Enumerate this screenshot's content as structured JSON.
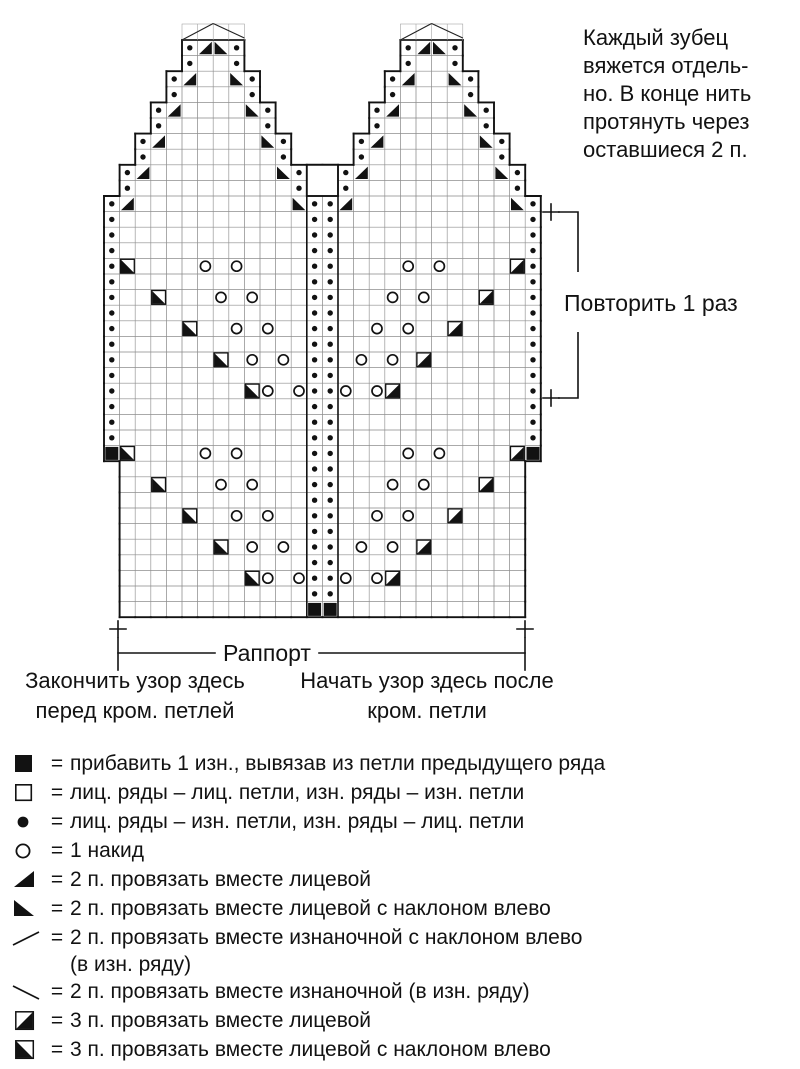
{
  "note": {
    "lines": [
      "Каждый зубец",
      "вяжется отдель-",
      "но. В конце нить",
      "протянуть через",
      "оставшиеся 2 п."
    ]
  },
  "repeat_label": "Повторить 1 раз",
  "rapport_label": "Раппорт",
  "end_label": {
    "line1": "Закончить узор здесь",
    "line2": "перед кром. петлей"
  },
  "start_label": {
    "line1": "Начать узор здесь после",
    "line2": "кром. петли"
  },
  "legend_eq": "=",
  "chart": {
    "type": "knitting-chart",
    "columns": 28,
    "rows": 37,
    "cell_codes": {
      "p": "purl-dot",
      ".": "knit-empty-cell",
      "O": "yarnover-circle",
      "a": "k2tog-filled-triangle-bottom-right",
      "b": "k2tog-left-filled-triangle-bottom-left",
      "q": "k3tog-left-square-lower-left-filled",
      "d": "k3tog-square-lower-right-filled",
      "M": "make1-purl-filled-square",
      "X": "tooth-join-box",
      "_": "no-cell"
    },
    "rows_top_to_bottom": [
      "_____pabp__________pabp_____",
      "_____p..p__________p..p_____",
      "____pa..bp________pa..bp____",
      "____p....p________p....p____",
      "___pa....bp______pa....bp___",
      "___p......p______p......p___",
      "__pa......bp____pa......bp__",
      "__p........p____p........p__",
      "_pa........bpXXpa........bp_",
      "_p..........pXXp..........p_",
      "pa..........bppa..........bp",
      "p............pp............p",
      "p............pp............p",
      "p............pp............p",
      "pq....O.O....pp....O.O....dp",
      "p............pp............p",
      "p..q...O.O...pp...O.O...d..p",
      "p............pp............p",
      "p....q..O.O..pp..O.O..d....p",
      "p............pp............p",
      "p......q.O.O.pp.O.O.d......p",
      "p............pp............p",
      "p........qO.OppO.Od........p",
      "p............pp............p",
      "p............pp............p",
      "p............pp............p",
      "Mq....O.O....pp....O.O....dM",
      "_............pp............_",
      "_..q...O.O...pp...O.O...d.._",
      "_............pp............_",
      "_....q..O.O..pp..O.O..d...._",
      "_............pp............_",
      "_......q.O.O.pp.O.O.d......_",
      "_............pp............_",
      "_........qO.OppO.Od........_",
      "_............pp............_",
      "_............MM............_"
    ],
    "pentagon_apex_cols": [
      [
        5,
        8
      ],
      [
        19,
        22
      ]
    ]
  },
  "legend": [
    {
      "symbol": "square-filled",
      "text": "прибавить 1 изн., вывязав из петли предыдущего ряда"
    },
    {
      "symbol": "square-empty",
      "text": "лиц. ряды – лиц. петли, изн. ряды – изн. петли"
    },
    {
      "symbol": "dot-filled",
      "text": "лиц. ряды – изн. петли, изн. ряды – лиц. петли"
    },
    {
      "symbol": "circle-empty",
      "text": "1 накид"
    },
    {
      "symbol": "triangle-bottom-right",
      "text": "2 п. провязать вместе лицевой"
    },
    {
      "symbol": "triangle-bottom-left",
      "text": "2 п. провязать вместе лицевой с наклоном влево"
    },
    {
      "symbol": "slash",
      "text": "2 п. провязать вместе изнаночной с наклоном влево",
      "text2": "(в изн. ряду)"
    },
    {
      "symbol": "backslash",
      "text": "2 п. провязать вместе изнаночной (в изн. ряду)"
    },
    {
      "symbol": "square-lower-right-filled",
      "text": "3 п. провязать вместе лицевой"
    },
    {
      "symbol": "square-lower-left-filled",
      "text": "3 п. провязать вместе лицевой с наклоном влево"
    }
  ]
}
